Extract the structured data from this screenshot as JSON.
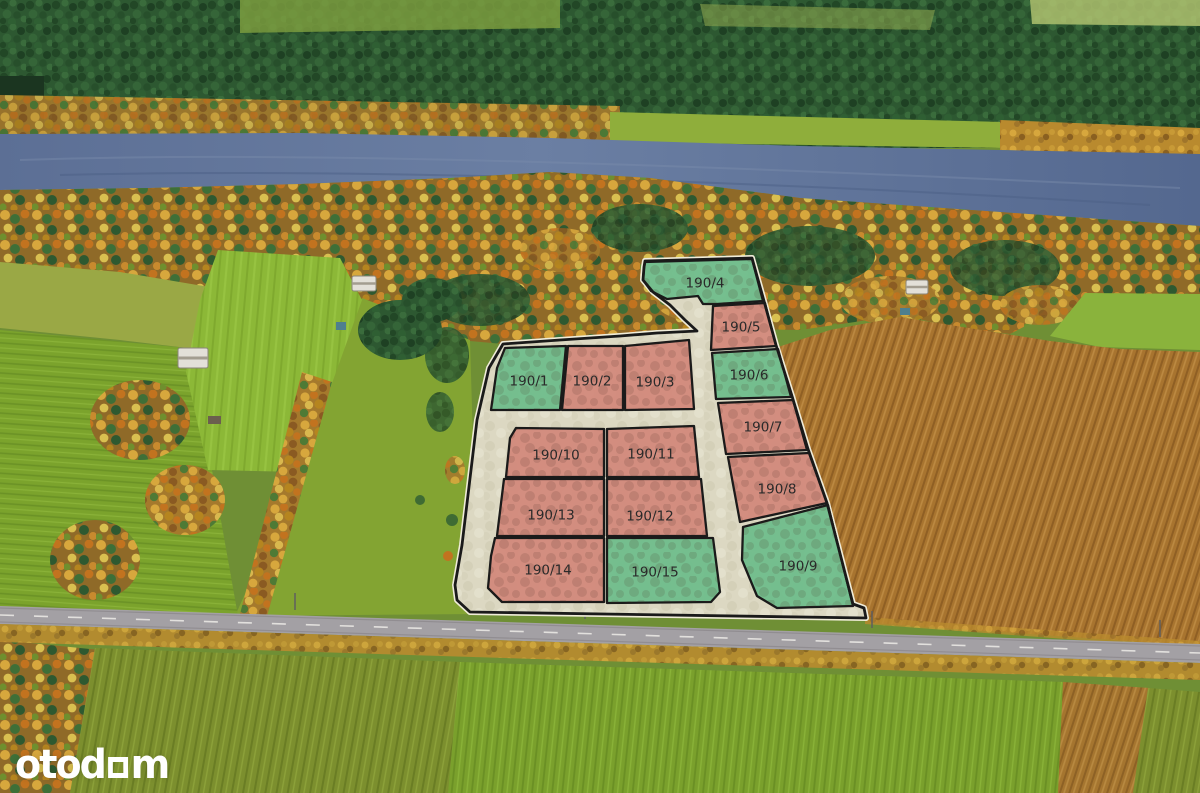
{
  "logo": {
    "text": "otodom",
    "render": {
      "before": "otod",
      "after": "m"
    },
    "color": "#ffffff"
  },
  "overlay": {
    "road_fill": "#dcd8c2",
    "outline_color": "#1a1a1a",
    "edge_halo": "#f0ecd9",
    "label_color": "#2a2a2a",
    "label_size": 13.5,
    "status_colors": {
      "green": "#6fbd8b",
      "salmon": "#d2897b"
    },
    "boundary": [
      [
        645,
        261
      ],
      [
        752,
        258
      ],
      [
        764,
        301
      ],
      [
        776,
        345
      ],
      [
        792,
        396
      ],
      [
        808,
        449
      ],
      [
        827,
        503
      ],
      [
        853,
        604
      ],
      [
        864,
        608
      ],
      [
        866,
        618
      ],
      [
        470,
        612
      ],
      [
        457,
        600
      ],
      [
        455,
        585
      ],
      [
        462,
        545
      ],
      [
        471,
        470
      ],
      [
        477,
        420
      ],
      [
        489,
        368
      ],
      [
        503,
        344
      ],
      [
        560,
        340
      ],
      [
        620,
        336
      ],
      [
        657,
        333
      ],
      [
        697,
        331
      ],
      [
        685,
        320
      ],
      [
        670,
        305
      ],
      [
        653,
        292
      ],
      [
        643,
        280
      ],
      [
        644,
        267
      ]
    ],
    "plots": [
      {
        "id": "190/1",
        "color": "green",
        "points": [
          [
            505,
            348
          ],
          [
            566,
            346
          ],
          [
            560,
            410
          ],
          [
            491,
            410
          ],
          [
            497,
            368
          ]
        ],
        "label_at": [
          529,
          381
        ]
      },
      {
        "id": "190/2",
        "color": "salmon",
        "points": [
          [
            568,
            346
          ],
          [
            623,
            346
          ],
          [
            623,
            410
          ],
          [
            562,
            410
          ]
        ],
        "label_at": [
          592,
          381
        ]
      },
      {
        "id": "190/3",
        "color": "salmon",
        "points": [
          [
            625,
            346
          ],
          [
            689,
            340
          ],
          [
            694,
            409
          ],
          [
            625,
            410
          ]
        ],
        "label_at": [
          655,
          382
        ]
      },
      {
        "id": "190/4",
        "color": "green",
        "points": [
          [
            645,
            262
          ],
          [
            752,
            259
          ],
          [
            763,
            301
          ],
          [
            717,
            304
          ],
          [
            703,
            304
          ],
          [
            698,
            296
          ],
          [
            667,
            299
          ],
          [
            651,
            291
          ],
          [
            643,
            280
          ],
          [
            644,
            268
          ]
        ],
        "label_at": [
          705,
          283
        ]
      },
      {
        "id": "190/5",
        "color": "salmon",
        "points": [
          [
            713,
            306
          ],
          [
            765,
            303
          ],
          [
            776,
            346
          ],
          [
            711,
            350
          ]
        ],
        "label_at": [
          741,
          327
        ]
      },
      {
        "id": "190/6",
        "color": "green",
        "points": [
          [
            712,
            353
          ],
          [
            778,
            349
          ],
          [
            791,
            397
          ],
          [
            716,
            399
          ]
        ],
        "label_at": [
          749,
          375
        ]
      },
      {
        "id": "190/7",
        "color": "salmon",
        "points": [
          [
            718,
            403
          ],
          [
            793,
            400
          ],
          [
            807,
            450
          ],
          [
            726,
            454
          ]
        ],
        "label_at": [
          763,
          427
        ]
      },
      {
        "id": "190/8",
        "color": "salmon",
        "points": [
          [
            728,
            457
          ],
          [
            809,
            453
          ],
          [
            827,
            503
          ],
          [
            740,
            522
          ]
        ],
        "label_at": [
          777,
          489
        ]
      },
      {
        "id": "190/9",
        "color": "green",
        "points": [
          [
            743,
            527
          ],
          [
            828,
            505
          ],
          [
            853,
            606
          ],
          [
            777,
            608
          ],
          [
            757,
            596
          ],
          [
            742,
            560
          ]
        ],
        "label_at": [
          798,
          566
        ]
      },
      {
        "id": "190/10",
        "color": "salmon",
        "points": [
          [
            516,
            428
          ],
          [
            604,
            429
          ],
          [
            604,
            477
          ],
          [
            506,
            477
          ],
          [
            510,
            438
          ]
        ],
        "label_at": [
          556,
          455
        ]
      },
      {
        "id": "190/11",
        "color": "salmon",
        "points": [
          [
            607,
            429
          ],
          [
            694,
            426
          ],
          [
            699,
            477
          ],
          [
            607,
            477
          ]
        ],
        "label_at": [
          651,
          454
        ]
      },
      {
        "id": "190/12",
        "color": "salmon",
        "points": [
          [
            607,
            479
          ],
          [
            701,
            479
          ],
          [
            707,
            536
          ],
          [
            607,
            536
          ]
        ],
        "label_at": [
          650,
          516
        ]
      },
      {
        "id": "190/13",
        "color": "salmon",
        "points": [
          [
            504,
            479
          ],
          [
            604,
            479
          ],
          [
            604,
            536
          ],
          [
            497,
            536
          ]
        ],
        "label_at": [
          551,
          515
        ]
      },
      {
        "id": "190/14",
        "color": "salmon",
        "points": [
          [
            495,
            538
          ],
          [
            604,
            538
          ],
          [
            604,
            602
          ],
          [
            502,
            602
          ],
          [
            488,
            588
          ],
          [
            491,
            556
          ]
        ],
        "label_at": [
          548,
          570
        ]
      },
      {
        "id": "190/15",
        "color": "green",
        "points": [
          [
            607,
            538
          ],
          [
            713,
            538
          ],
          [
            720,
            592
          ],
          [
            711,
            602
          ],
          [
            607,
            603
          ]
        ],
        "label_at": [
          655,
          572
        ]
      }
    ]
  },
  "scene_palette": {
    "river": "#5e7398",
    "forest_dark": "#2d5831",
    "autumn": "#c28830",
    "farmland_green": "#7ba32c",
    "plowed_field": "#a8742f",
    "asphalt_road": "#a3a0a4",
    "bottom_field": "#748c28"
  }
}
